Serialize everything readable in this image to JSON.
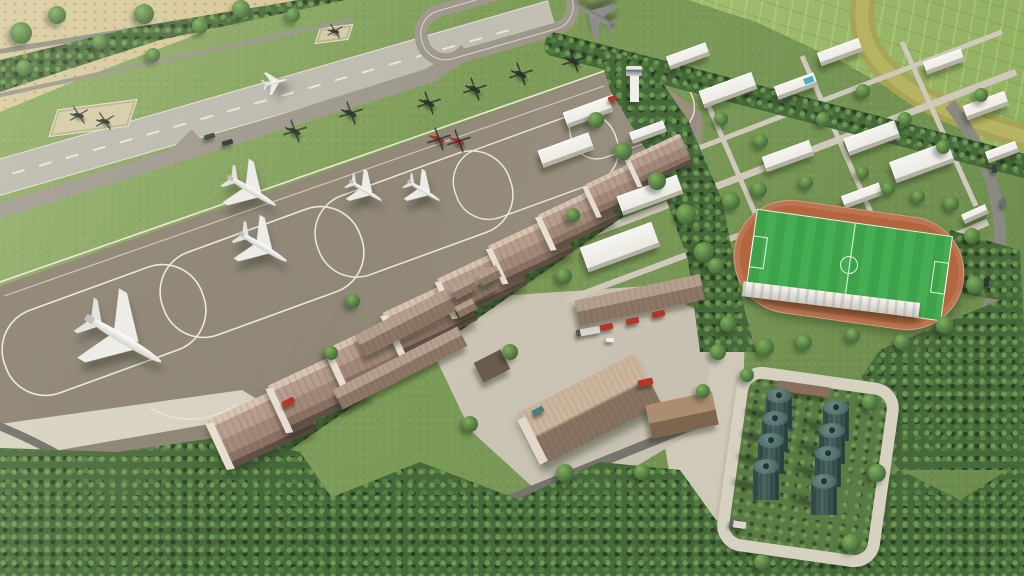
{
  "scene": {
    "title": "Aerial 3D architectural render of a military airbase",
    "description": "Daytime bird's-eye 3D rendering of an airbase: diagonal runway with parallel taxiway and loop, large parking apron with white taxi-lane loops, parked airliner, turboprops and helicopter line, a row of barrel-roof hangars, tree-lined logistics district with brown warehouses and fire trucks, white campus buildings with control tower, soccer stadium with running track, eight fuel storage tanks, farmland with a river at top right and dense tree belts"
  },
  "palette": {
    "grass": "#7d9b58",
    "grass-light": "#8cab63",
    "grass-dark": "#6a8a4c",
    "forest": "#47683a",
    "field-tan": "#cfc083",
    "farm-green": "#a2bd6f",
    "river": "#a6a455",
    "runway": "#bcb9af",
    "taxiway": "#9d978c",
    "apron": "#938a7a",
    "marking": "#eceadf",
    "concrete": "#c9c2b2",
    "concrete-light": "#d7d1c2",
    "hangar-roof": "#b69c8c",
    "hangar-face": "#e8ddd0",
    "warehouse-roof": "#9b8577",
    "building-white": "#f3f2ee",
    "track": "#b4663e",
    "pitch": "#3da24a",
    "tank-body": "#44605c",
    "tank-top": "#6e8b85",
    "road": "#8b8a82",
    "road-dark": "#6e6c64",
    "fire-red": "#b5352a"
  },
  "inventory": {
    "runways": 1,
    "parallel_taxiways": 1,
    "helipads": 2,
    "parked_airplanes": 6,
    "airplane_on_runway": 1,
    "helicopters_dark": 9,
    "helicopters_red": 2,
    "hangars": 9,
    "warehouses": 7,
    "fire_trucks": 4,
    "campus_buildings": 16,
    "control_towers": 1,
    "entrance_gates": 1,
    "soccer_fields": 1,
    "running_tracks": 1,
    "grandstands": 1,
    "fuel_tanks": 8,
    "swimming_pools": 1
  }
}
